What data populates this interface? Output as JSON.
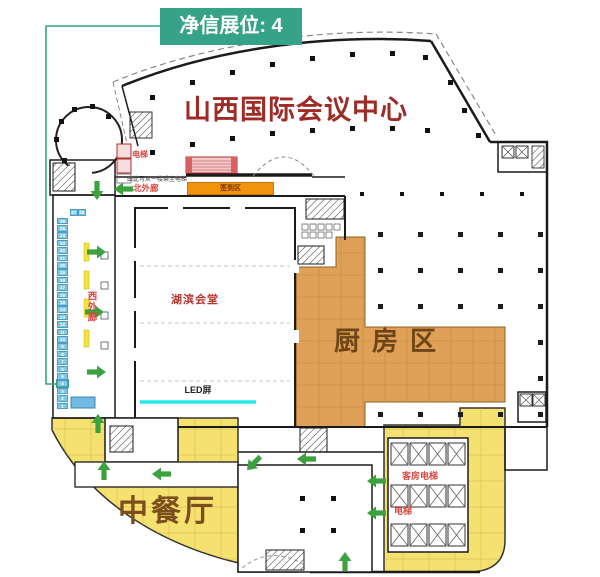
{
  "badge": {
    "label": "净信展位: 4"
  },
  "title": "山西国际会议中心",
  "rooms": {
    "hall": "湖滨会堂",
    "kitchen": "厨房区",
    "restaurant": "中餐厅",
    "registration_area": "签到区",
    "led_screen": "LED屏"
  },
  "corridors": {
    "north": "北外廊",
    "west": "西外廊"
  },
  "elevators": {
    "northwest": "电梯",
    "guest_rooms": "客房电梯",
    "southeast": "电梯"
  },
  "notes": {
    "escalator_access": "由此可从一楼乘坐电梯"
  },
  "booths": {
    "count": 28,
    "highlighted": 4
  },
  "colors": {
    "badge": "#36A287",
    "title_red": "#9E2B25",
    "label_red": "#D8453E",
    "kitchen_fill": "#DFA057",
    "restaurant_fill": "#F5E170",
    "registration_bar": "#F2930D",
    "booth_fill": "#82C8E6",
    "arrow_green": "#3BA23F",
    "led_line": "#29E8E8",
    "connector_teal": "#36A287"
  }
}
